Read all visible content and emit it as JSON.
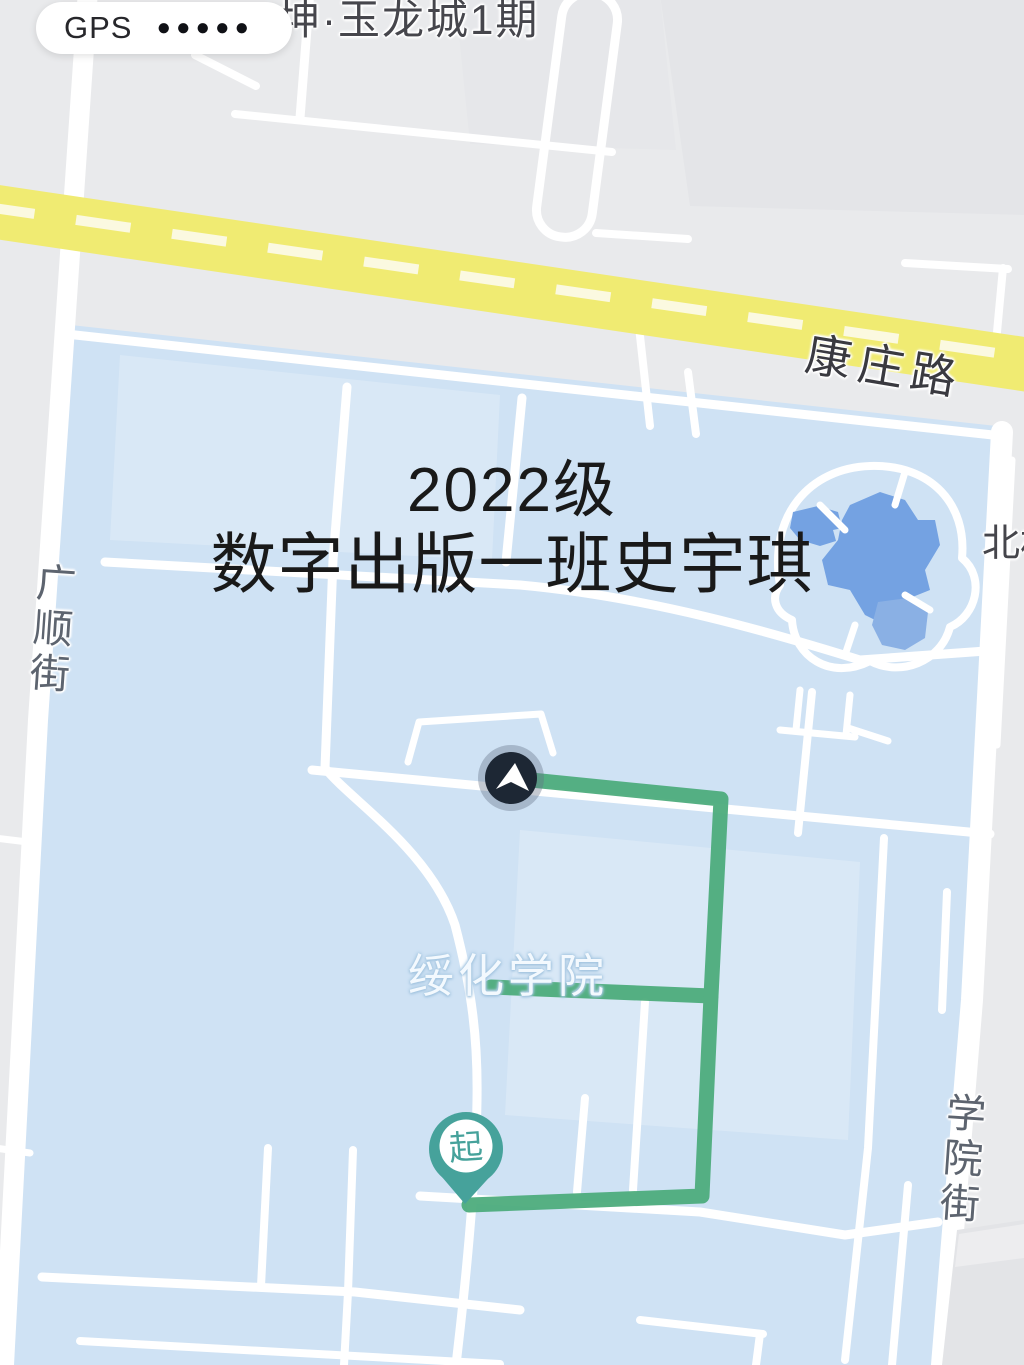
{
  "status": {
    "gps_label": "GPS",
    "gps_dots_count": 5,
    "gps_dots_glyph": "●●●●●"
  },
  "overlay_title": {
    "line1": "2022级",
    "line2": "数字出版一班史宇琪"
  },
  "map_labels": {
    "residential_top": "坤·玉龙城1期",
    "main_road": "康庄路",
    "left_street": "广顺街",
    "right_street": "学院街",
    "campus": "绥化学院",
    "north_area": "北村",
    "start_pin": "起"
  },
  "colors": {
    "background": "#e9eaec",
    "campus_fill": "#cfe2f4",
    "road_white": "#ffffff",
    "road_highlight": "#f0eb72",
    "road_highlight_dash": "#fbf9e0",
    "route_green": "#4dac7c",
    "pond_blue": "#74a2e2",
    "pond_blue_light": "#8ab0e4",
    "marker_navy": "#1d2734",
    "marker_ring": "rgba(100,112,135,0.38)",
    "pin_teal": "#46a29b"
  }
}
